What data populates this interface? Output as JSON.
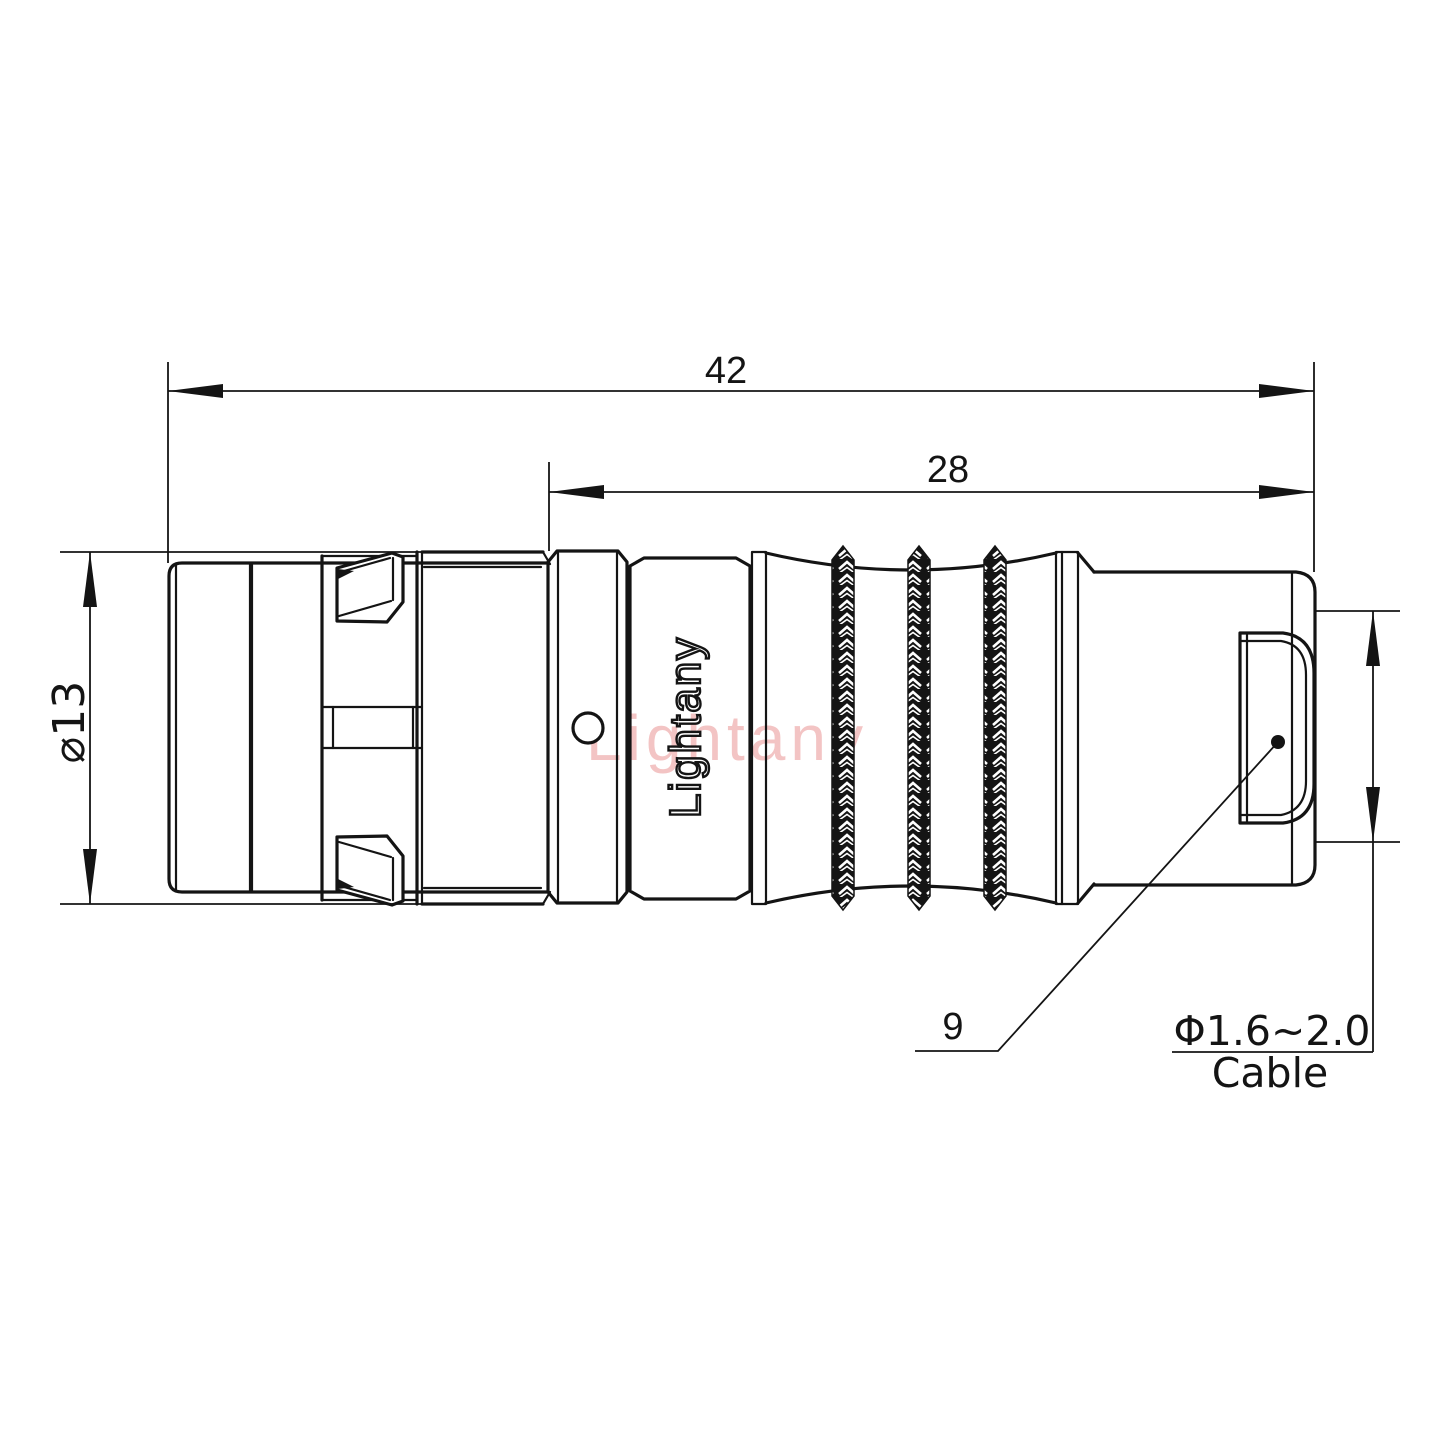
{
  "theme": {
    "line_color": "#141414",
    "watermark_color": "#f3c4c4",
    "background": "#ffffff"
  },
  "watermark": {
    "text": "Lightany"
  },
  "brand": {
    "text": "Lightany"
  },
  "dimensions": {
    "total_length": "42",
    "front_to_end_length": "28",
    "outer_diameter": "⌀13",
    "shell_size": "9",
    "cable_diameter_range": "Φ1.6~2.0",
    "cable_word": "Cable"
  }
}
